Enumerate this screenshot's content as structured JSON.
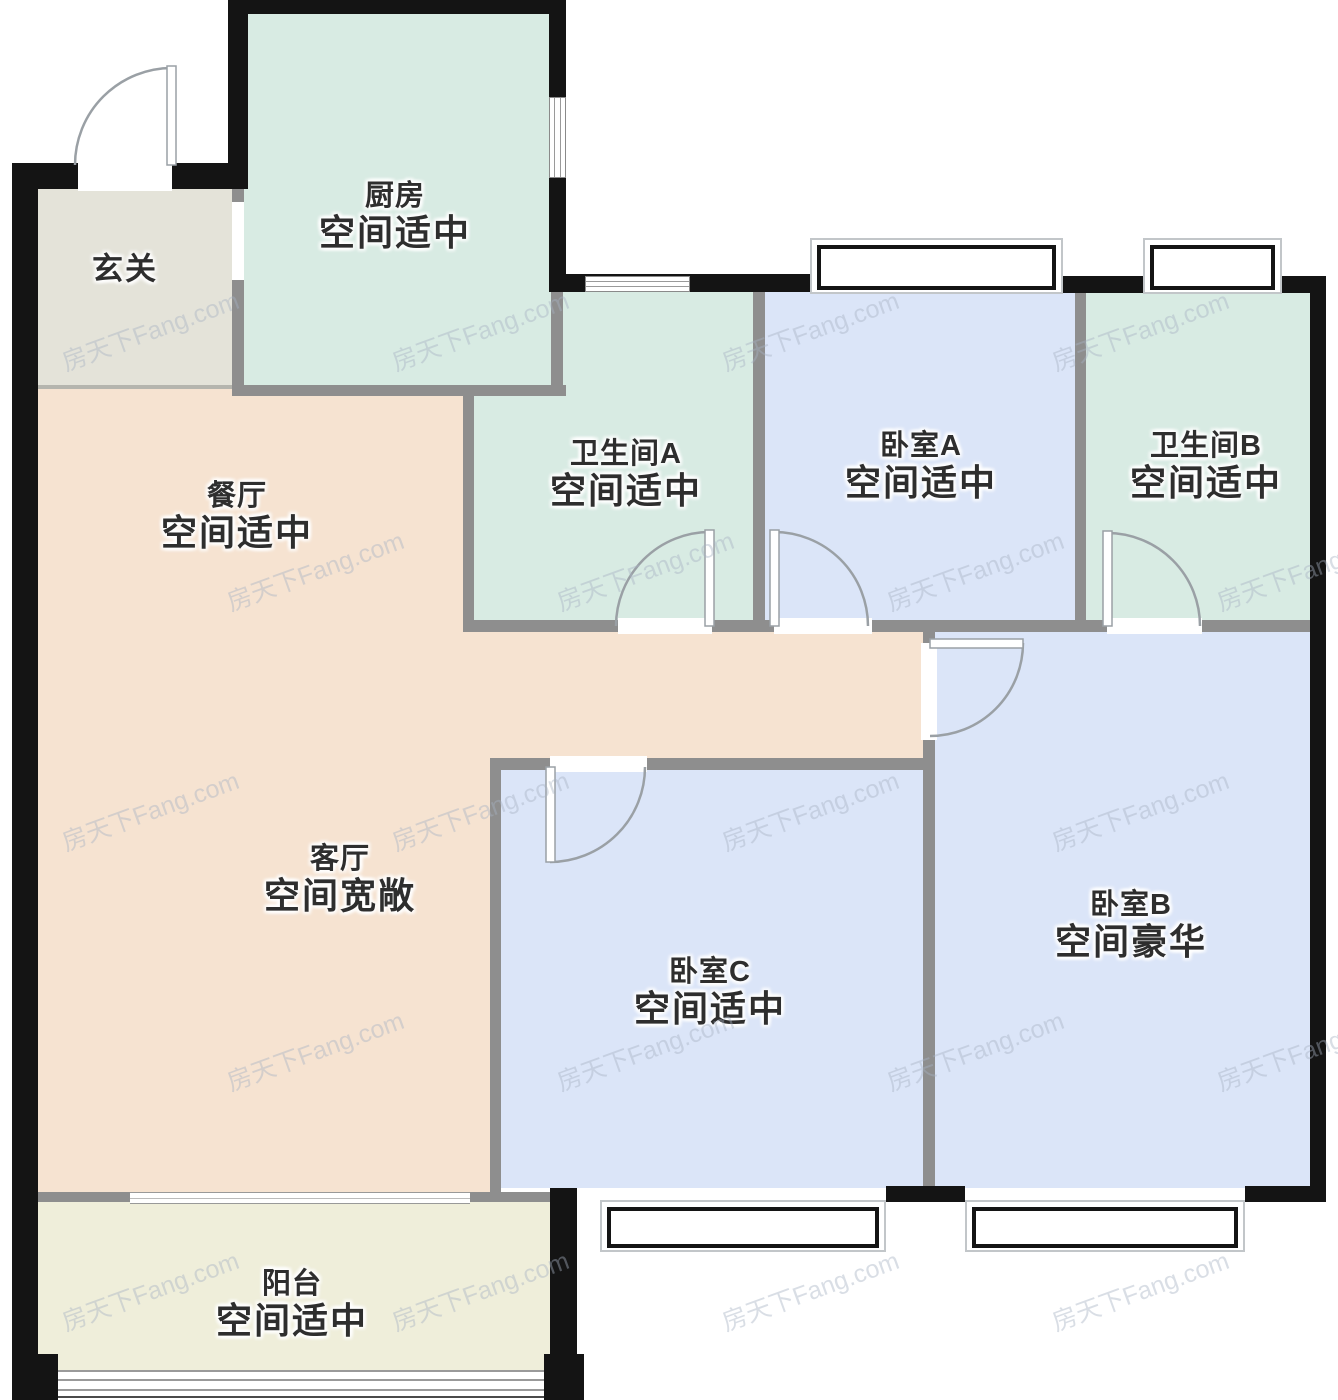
{
  "watermark": {
    "text": "房天下Fang.com"
  },
  "colors": {
    "exterior_wall": "#141414",
    "interior_wall": "#8e8e8e",
    "kitchen_bath_fill": "#d8ebe3",
    "bedroom_fill": "#dbe5f8",
    "living_dining_fill": "#f6e3d1",
    "foyer_fill": "#e4e3d9",
    "balcony_fill": "#efeeda",
    "label_text": "#2e2e2e",
    "door_stroke": "#9aa0a5"
  },
  "rooms": {
    "foyer": {
      "name": "玄关",
      "desc": ""
    },
    "kitchen": {
      "name": "厨房",
      "desc": "空间适中"
    },
    "dining": {
      "name": "餐厅",
      "desc": "空间适中"
    },
    "bathroom_a": {
      "name": "卫生间A",
      "desc": "空间适中"
    },
    "bedroom_a": {
      "name": "卧室A",
      "desc": "空间适中"
    },
    "bathroom_b": {
      "name": "卫生间B",
      "desc": "空间适中"
    },
    "living": {
      "name": "客厅",
      "desc": "空间宽敞"
    },
    "bedroom_c": {
      "name": "卧室C",
      "desc": "空间适中"
    },
    "bedroom_b": {
      "name": "卧室B",
      "desc": "空间豪华"
    },
    "balcony": {
      "name": "阳台",
      "desc": "空间适中"
    }
  }
}
